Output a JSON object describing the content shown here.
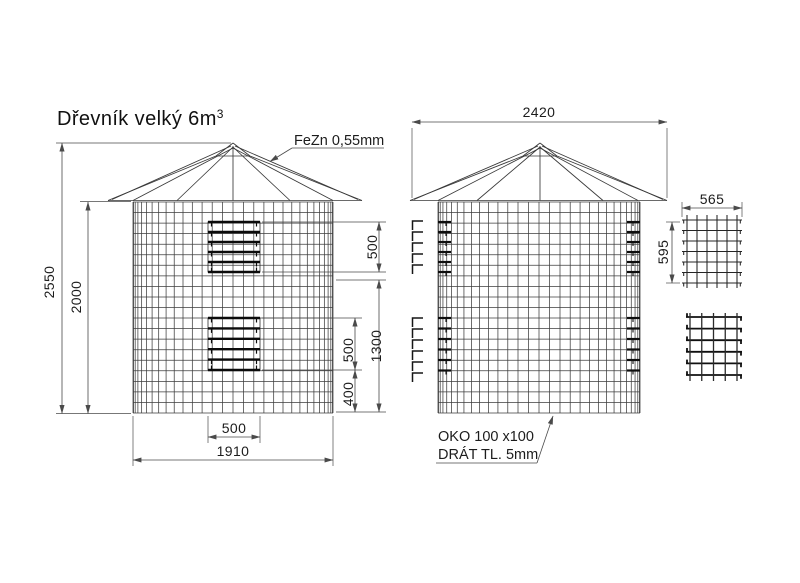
{
  "title": {
    "text": "Dřevník velký 6m",
    "exponent": "3"
  },
  "labels": {
    "roof_material": "FeZn 0,55mm",
    "mesh_spec_line1": "OKO 100 x100",
    "mesh_spec_line2": "DRÁT TL. 5mm"
  },
  "dimensions": {
    "front_view": {
      "total_height": "2550",
      "cylinder_height": "2000",
      "top_opening_height": "500",
      "openings_span": "1300",
      "bottom_opening_height": "500",
      "bottom_offset": "400",
      "opening_width": "500",
      "cylinder_width": "1910"
    },
    "side_view": {
      "roof_width": "2420"
    },
    "panel_detail": {
      "panel_width": "565",
      "panel_height": "595"
    }
  }
}
